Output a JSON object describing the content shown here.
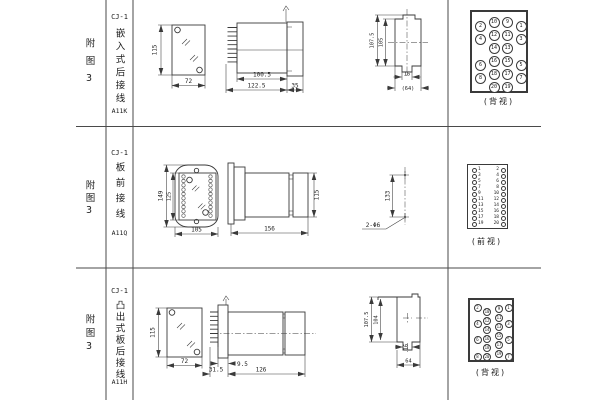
{
  "rows": [
    {
      "fig_label": "附图3",
      "model": "CJ-1",
      "mount_type": "嵌入式后接线",
      "code": "A11K",
      "dims": {
        "front_h": "115",
        "front_w": "72",
        "depth_body": "100.5",
        "depth_total": "122.5",
        "bezel": "35",
        "cut_h1": "107.5",
        "cut_h2": "105",
        "cut_w1": "16",
        "cut_w2": "(64)"
      },
      "terminal_caption": "(背视)"
    },
    {
      "fig_label": "附图3",
      "model": "CJ-1",
      "mount_type": "板前接线",
      "code": "A11Q",
      "dims": {
        "front_h1": "149",
        "front_h2": "125",
        "front_w": "105",
        "side_len": "156",
        "side_h": "115",
        "hole_pitch": "133",
        "hole_note": "2-Φ6"
      },
      "terminal_caption": "(前视)"
    },
    {
      "fig_label": "附图3",
      "model": "CJ-1",
      "mount_type": "凸出式板后接线",
      "code": "A11H",
      "dims": {
        "front_h": "115",
        "front_w": "72",
        "d1": "31.5",
        "d2": "9.5",
        "d3": "126",
        "cut_h1": "107.5",
        "cut_h2": "104",
        "cut_w1": "16",
        "cut_w2": "64"
      },
      "terminal_caption": "(背视)"
    }
  ],
  "terminal_blocks": {
    "a11k": {
      "d": 11,
      "f": 5,
      "num_in": true,
      "w": 58,
      "items": [
        {
          "x": 8.5,
          "y": 14,
          "n": 2
        },
        {
          "x": 22,
          "y": 10.5,
          "n": 10
        },
        {
          "x": 35.5,
          "y": 10.5,
          "n": 9
        },
        {
          "x": 49,
          "y": 14,
          "n": 1
        },
        {
          "x": 8.5,
          "y": 27,
          "n": 4
        },
        {
          "x": 22,
          "y": 23.5,
          "n": 12
        },
        {
          "x": 35.5,
          "y": 23.5,
          "n": 11
        },
        {
          "x": 49,
          "y": 27,
          "n": 3
        },
        {
          "x": 22,
          "y": 36.5,
          "n": 14
        },
        {
          "x": 35.5,
          "y": 36.5,
          "n": 13
        },
        {
          "x": 8.5,
          "y": 53,
          "n": 6
        },
        {
          "x": 22,
          "y": 49.5,
          "n": 16
        },
        {
          "x": 35.5,
          "y": 49.5,
          "n": 15
        },
        {
          "x": 49,
          "y": 53,
          "n": 5
        },
        {
          "x": 8.5,
          "y": 66,
          "n": 8
        },
        {
          "x": 22,
          "y": 62.5,
          "n": 18
        },
        {
          "x": 35.5,
          "y": 62.5,
          "n": 17
        },
        {
          "x": 49,
          "y": 66,
          "n": 7
        },
        {
          "x": 22,
          "y": 75.5,
          "n": 20
        },
        {
          "x": 35.5,
          "y": 75.5,
          "n": 19
        }
      ]
    },
    "a11q": {
      "d": 5,
      "f": 4.5,
      "num_in": false,
      "w": 41,
      "items": [
        {
          "x": 6,
          "y": 5.5,
          "n": 1,
          "side": "r"
        },
        {
          "x": 35,
          "y": 5.5,
          "n": 2,
          "side": "l"
        },
        {
          "x": 6,
          "y": 11.5,
          "n": 3,
          "side": "r"
        },
        {
          "x": 35,
          "y": 11.5,
          "n": 4,
          "side": "l"
        },
        {
          "x": 6,
          "y": 17.5,
          "n": 5,
          "side": "r"
        },
        {
          "x": 35,
          "y": 17.5,
          "n": 6,
          "side": "l"
        },
        {
          "x": 6,
          "y": 23.5,
          "n": 7,
          "side": "r"
        },
        {
          "x": 35,
          "y": 23.5,
          "n": 8,
          "side": "l"
        },
        {
          "x": 6,
          "y": 29.5,
          "n": 9,
          "side": "r"
        },
        {
          "x": 35,
          "y": 29.5,
          "n": 10,
          "side": "l"
        },
        {
          "x": 6,
          "y": 35.5,
          "n": 11,
          "side": "r"
        },
        {
          "x": 35,
          "y": 35.5,
          "n": 12,
          "side": "l"
        },
        {
          "x": 6,
          "y": 41.5,
          "n": 13,
          "side": "r"
        },
        {
          "x": 35,
          "y": 41.5,
          "n": 14,
          "side": "l"
        },
        {
          "x": 6,
          "y": 47.5,
          "n": 15,
          "side": "r"
        },
        {
          "x": 35,
          "y": 47.5,
          "n": 16,
          "side": "l"
        },
        {
          "x": 6,
          "y": 53.5,
          "n": 17,
          "side": "r"
        },
        {
          "x": 35,
          "y": 53.5,
          "n": 18,
          "side": "l"
        },
        {
          "x": 6,
          "y": 59.5,
          "n": 19,
          "side": "r"
        },
        {
          "x": 35,
          "y": 59.5,
          "n": 20,
          "side": "l"
        }
      ]
    },
    "a11h": {
      "d": 8,
      "f": 4,
      "num_in": true,
      "w": 46,
      "items": [
        {
          "x": 7.5,
          "y": 7.5,
          "n": 2
        },
        {
          "x": 17,
          "y": 12,
          "n": 10
        },
        {
          "x": 29,
          "y": 8.5,
          "n": 9
        },
        {
          "x": 38.5,
          "y": 7.5,
          "n": 1
        },
        {
          "x": 7.5,
          "y": 23.8,
          "n": 4
        },
        {
          "x": 17,
          "y": 21,
          "n": 12
        },
        {
          "x": 29,
          "y": 17.5,
          "n": 11
        },
        {
          "x": 38.5,
          "y": 23.8,
          "n": 3
        },
        {
          "x": 17,
          "y": 30,
          "n": 14
        },
        {
          "x": 29,
          "y": 26.5,
          "n": 13
        },
        {
          "x": 7.5,
          "y": 40.1,
          "n": 6
        },
        {
          "x": 17,
          "y": 39,
          "n": 16
        },
        {
          "x": 29,
          "y": 35.5,
          "n": 15
        },
        {
          "x": 38.5,
          "y": 40.1,
          "n": 5
        },
        {
          "x": 17,
          "y": 48,
          "n": 18
        },
        {
          "x": 29,
          "y": 44.5,
          "n": 17
        },
        {
          "x": 7.5,
          "y": 56.5,
          "n": 8
        },
        {
          "x": 17,
          "y": 57,
          "n": 20
        },
        {
          "x": 29,
          "y": 53.5,
          "n": 19
        },
        {
          "x": 38.5,
          "y": 56.5,
          "n": 7
        }
      ]
    }
  }
}
